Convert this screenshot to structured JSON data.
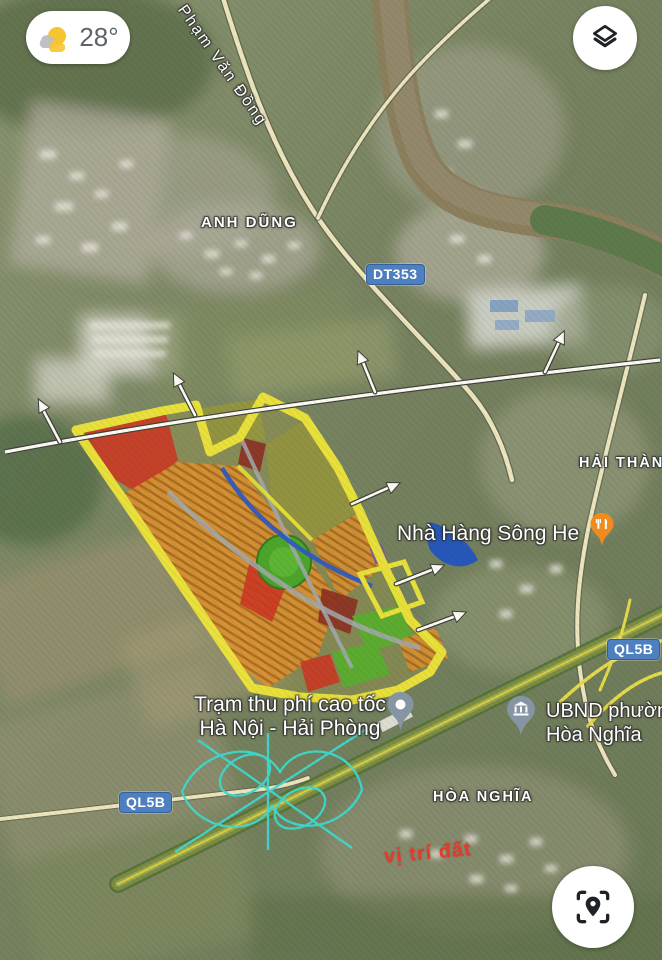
{
  "weather": {
    "temperature": "28°",
    "icon": "partly-cloudy-icon"
  },
  "controls": {
    "layers_icon": "layers-icon",
    "locate_icon": "locate-scan-icon"
  },
  "street": {
    "pham_van_dong": "Phạm Văn Đồng"
  },
  "areas": {
    "anh_dung": "ANH DŨNG",
    "hai_thanh": "HẢI THÀNH",
    "hoa_nghia": "HÒA NGHĨA"
  },
  "badges": {
    "dt353": "DT353",
    "ql5b_right": "QL5B",
    "ql5b_left": "QL5B"
  },
  "pois": {
    "restaurant": {
      "name": "Nhà Hàng Sông He",
      "icon": "restaurant-pin-icon",
      "pin_color": "#ef8b1f"
    },
    "toll": {
      "line1": "Trạm thu phí cao tốc",
      "line2": "Hà Nội - Hải Phòng",
      "icon": "toll-pin-icon",
      "pin_color": "#8695a4"
    },
    "ubnd": {
      "line1": "UBND phường",
      "line2": "Hòa Nghĩa",
      "icon": "government-pin-icon",
      "pin_color": "#8695a4"
    }
  },
  "annotation": {
    "vi_tri_dat": "vị trí đất",
    "color": "#e23b2e"
  },
  "colors": {
    "road_badge_blue": "#4e80bf",
    "plan_border_yellow": "#f1e838",
    "plan_red": "#d23420",
    "plan_dark_red": "#8e2b1f",
    "plan_orange": "#e0912f",
    "plan_olive": "#99993a",
    "plan_green": "#4aa827",
    "plan_water_blue": "#2050c8",
    "interchange_cyan": "#3fd9cf",
    "label_text": "#ffffff"
  }
}
